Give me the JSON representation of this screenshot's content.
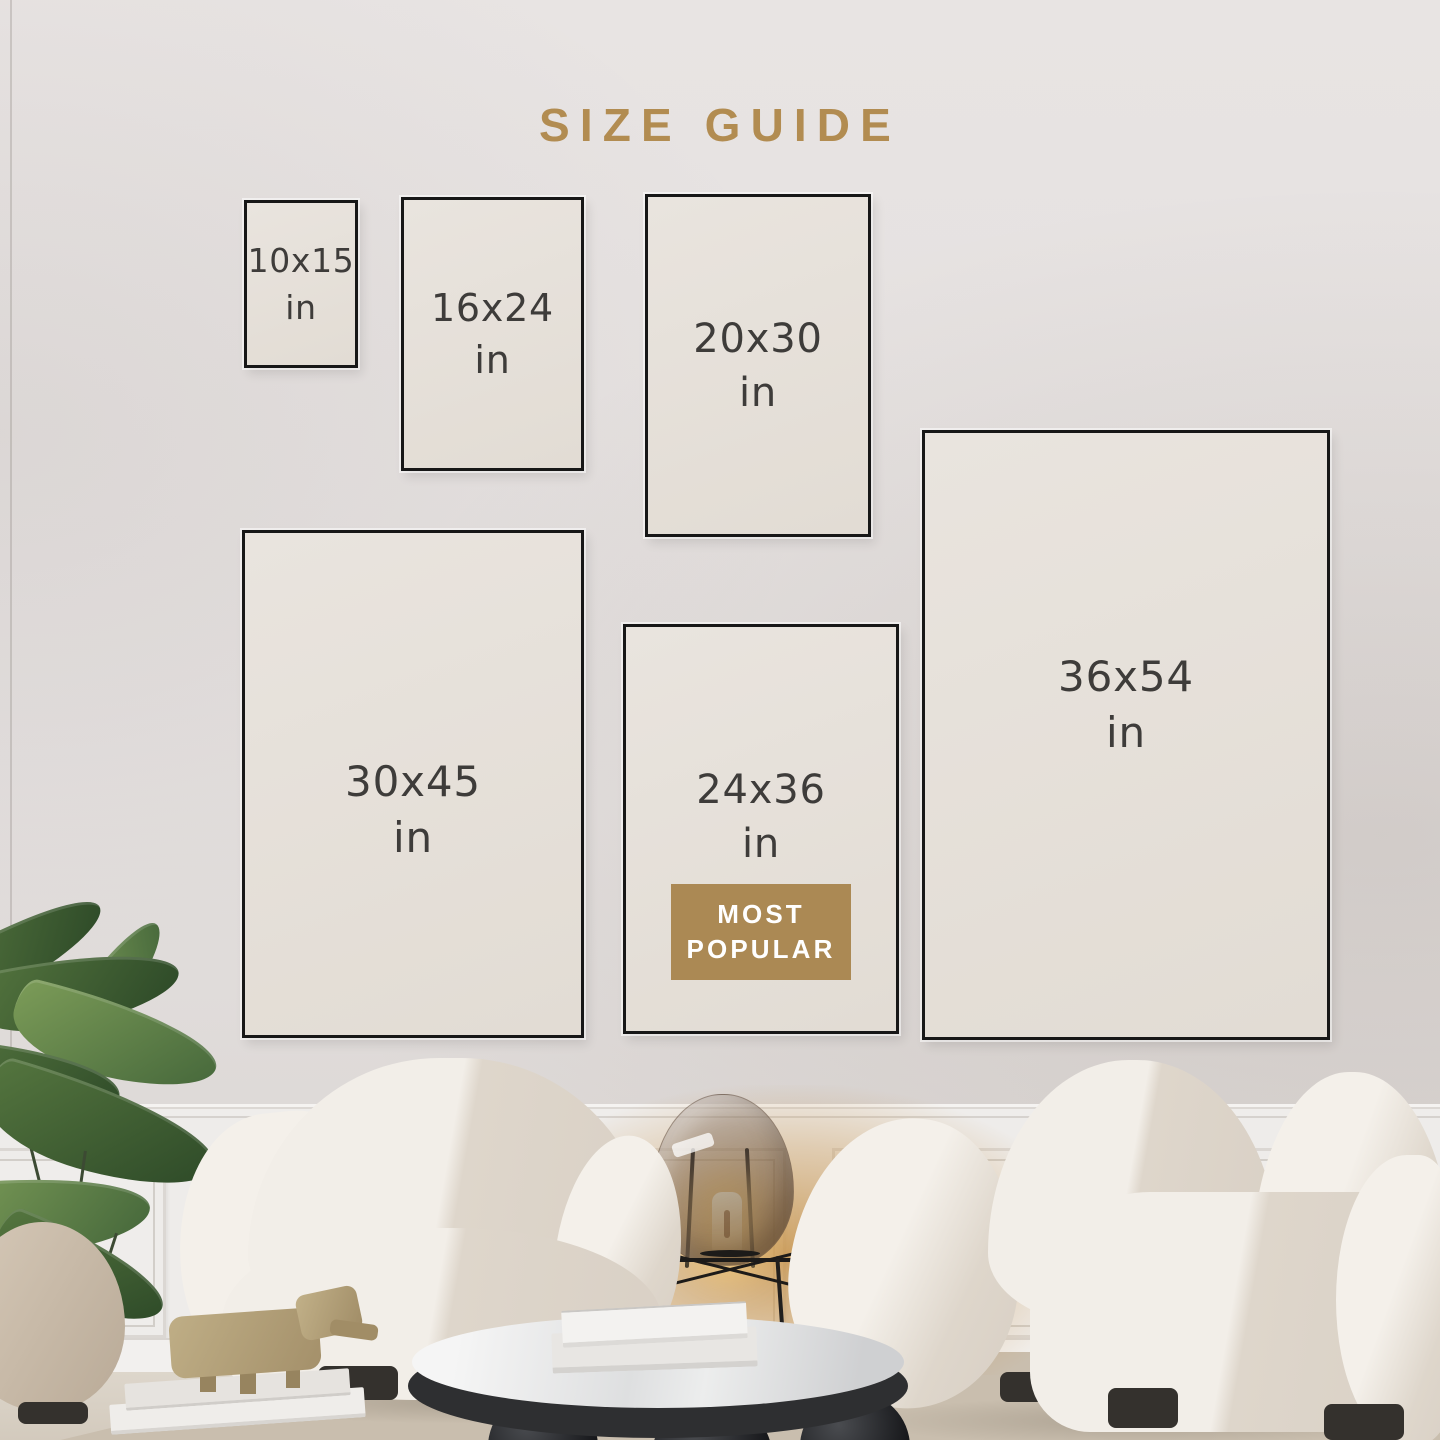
{
  "title": "SIZE GUIDE",
  "sizes": [
    {
      "dims": "10x15",
      "unit": "in"
    },
    {
      "dims": "16x24",
      "unit": "in"
    },
    {
      "dims": "20x30",
      "unit": "in"
    },
    {
      "dims": "30x45",
      "unit": "in"
    },
    {
      "dims": "24x36",
      "unit": "in",
      "badge": {
        "line1": "MOST",
        "line2": "POPULAR"
      }
    },
    {
      "dims": "36x54",
      "unit": "in"
    }
  ],
  "colors": {
    "title_gold": "#b28c51",
    "badge_gold": "#ab8954",
    "badge_text": "#ffffff",
    "frame_border": "#171717",
    "frame_fill": "#e7e2db",
    "label_text": "#3e3c3a"
  }
}
